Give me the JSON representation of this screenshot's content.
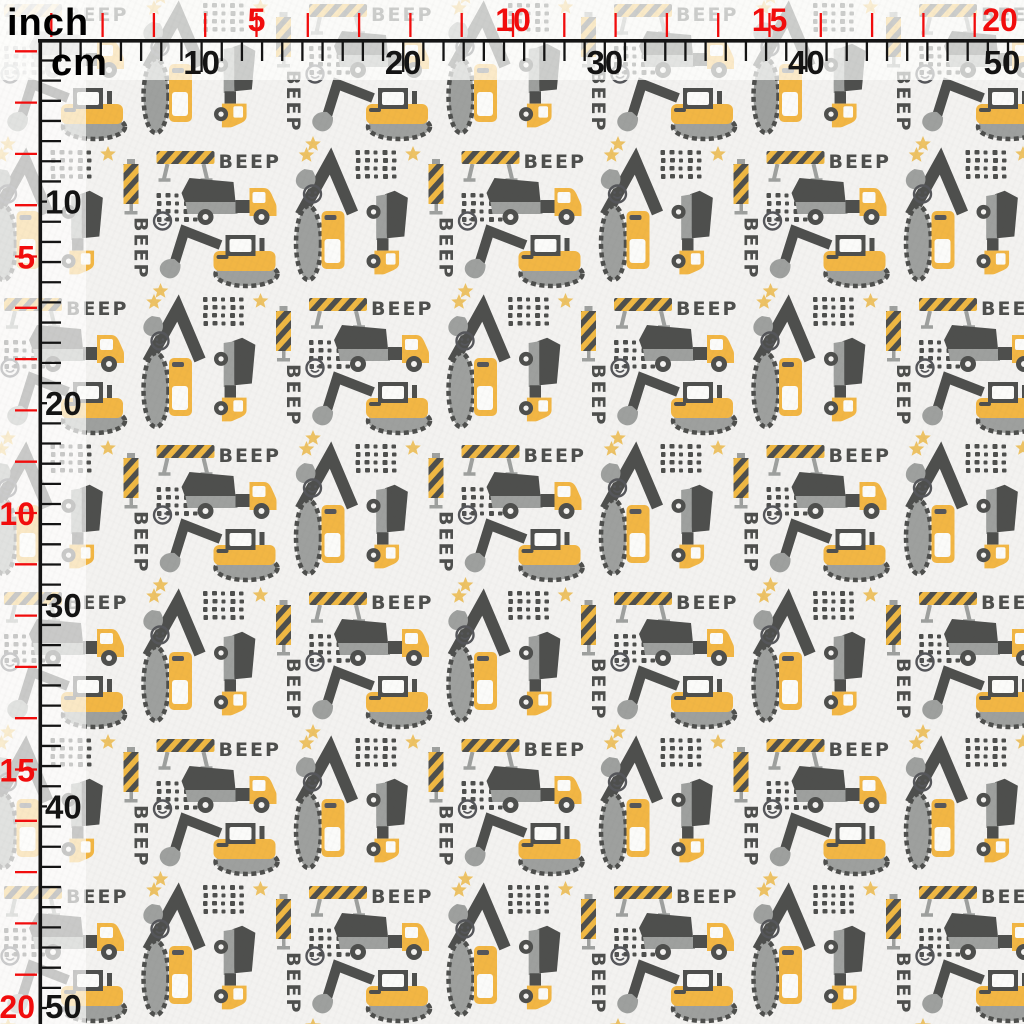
{
  "fabric": {
    "beep_text": "BEEP",
    "motifs": [
      "dump-truck",
      "excavator",
      "bulldozer",
      "road-barrier",
      "striped-pole",
      "dot-grid",
      "star",
      "smiley-pebble"
    ],
    "colors": {
      "background": "#f3f2f0",
      "vehicle_yellow": "#f2b644",
      "vehicle_gray": "#9ea09e",
      "vehicle_dark": "#4e4f4d",
      "star_yellow": "#edc264",
      "window_white": "#fbfbf9"
    }
  },
  "rulers": {
    "inch_unit_label": "inch",
    "cm_unit_label": "cm",
    "inch_color": "#f10d0d",
    "cm_color": "#141414",
    "top": {
      "cm_labels": [
        "10",
        "20",
        "30",
        "40",
        "50"
      ],
      "inch_labels": [
        "5",
        "10",
        "15",
        "20"
      ]
    },
    "left": {
      "cm_labels": [
        "10",
        "20",
        "30",
        "40",
        "50"
      ],
      "inch_labels": [
        "5",
        "10",
        "15",
        "20"
      ]
    }
  }
}
